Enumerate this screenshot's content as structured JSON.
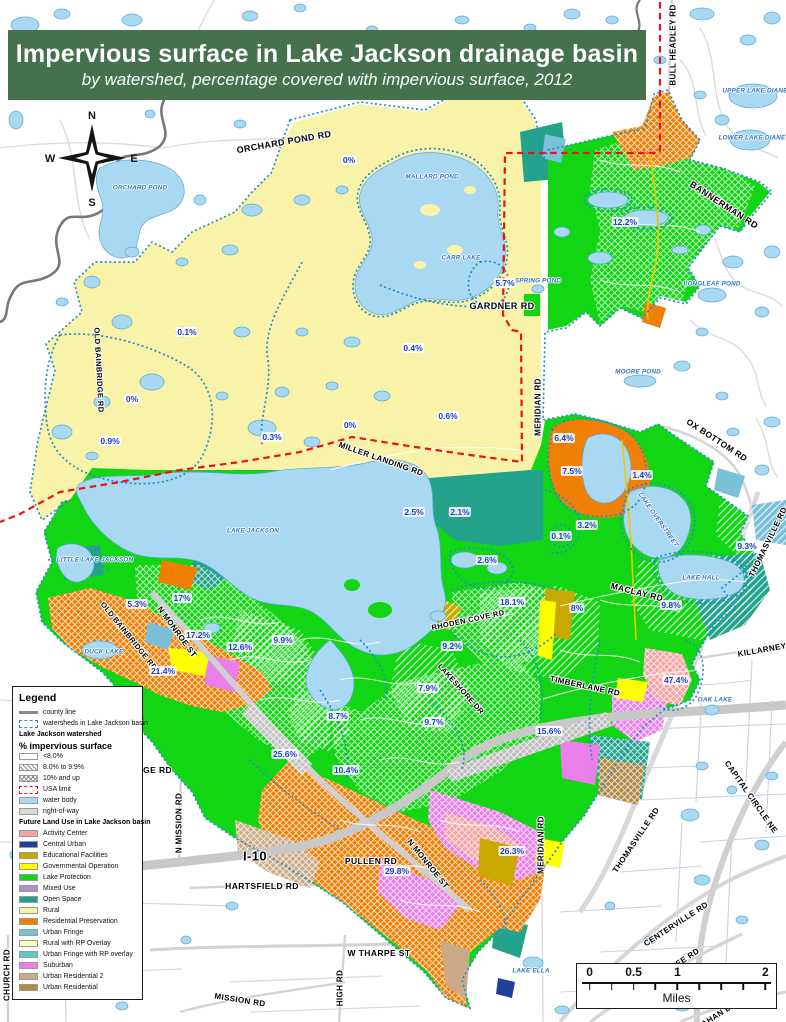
{
  "title": {
    "line1": "Impervious surface in Lake Jackson drainage basin",
    "line2": "by watershed, percentage covered with impervious surface, 2012"
  },
  "compass": {
    "n": "N",
    "e": "E",
    "s": "S",
    "w": "W"
  },
  "legend": {
    "title": "Legend",
    "items": [
      {
        "label": "county line",
        "type": "line",
        "color": "#8a8a8a"
      },
      {
        "label": "watersheds in Lake Jackson basin",
        "type": "dash",
        "color": "#1d8ec9"
      },
      {
        "label": "Lake Jackson watershed",
        "type": "header"
      },
      {
        "label": "% impervious surface",
        "type": "header-big"
      },
      {
        "label": "<8.0%",
        "type": "fill",
        "color": "#ffffff"
      },
      {
        "label": "8.0% to 9.9%",
        "type": "hatch-diag"
      },
      {
        "label": "10% and up",
        "type": "hatch-cross"
      },
      {
        "label": "USA limit",
        "type": "dash",
        "color": "#e81313"
      },
      {
        "label": "water body",
        "type": "fill",
        "color": "#a9d8f2"
      },
      {
        "label": "right-of-way",
        "type": "fill",
        "color": "#d9d9d9"
      },
      {
        "label": "Future Land Use in Lake Jackson basin",
        "type": "header"
      },
      {
        "label": "Activity Center",
        "type": "fill",
        "color": "#f5a3a3"
      },
      {
        "label": "Central Urban",
        "type": "fill",
        "color": "#20409a"
      },
      {
        "label": "Educational Facilities",
        "type": "fill",
        "color": "#c9a800"
      },
      {
        "label": "Governmental Operation",
        "type": "fill",
        "color": "#ffff00"
      },
      {
        "label": "Lake Protection",
        "type": "fill",
        "color": "#12d613"
      },
      {
        "label": "Mixed Use",
        "type": "fill",
        "color": "#b48fd0"
      },
      {
        "label": "Open Space",
        "type": "fill",
        "color": "#23a38c"
      },
      {
        "label": "Rural",
        "type": "fill",
        "color": "#f8f3a9"
      },
      {
        "label": "Residential Preservation",
        "type": "fill",
        "color": "#f08005"
      },
      {
        "label": "Urban Fringe",
        "type": "fill",
        "color": "#79c1d8"
      },
      {
        "label": "Rural with RP Overlay",
        "type": "fill",
        "color": "#fcf9c4"
      },
      {
        "label": "Urban Fringe with RP overlay",
        "type": "fill",
        "color": "#5cc8c4"
      },
      {
        "label": "Suburban",
        "type": "fill",
        "color": "#e97fe9"
      },
      {
        "label": "Urban Residential 2",
        "type": "fill",
        "color": "#cbab87"
      },
      {
        "label": "Urban Residential",
        "type": "fill",
        "color": "#b08948"
      }
    ]
  },
  "scalebar": {
    "unit": "Miles",
    "ticks": [
      {
        "label": "0",
        "pos": 4
      },
      {
        "label": "0.5",
        "pos": 27.3
      },
      {
        "label": "1",
        "pos": 50.5
      },
      {
        "label": "2",
        "pos": 97
      }
    ]
  },
  "map": {
    "roads": [
      {
        "t": "ORCHARD POND RD",
        "x": 284,
        "y": 142,
        "r": -10,
        "s": 9
      },
      {
        "t": "BULL HEADLEY RD",
        "x": 673,
        "y": 45,
        "r": -90,
        "s": 8
      },
      {
        "t": "BANNERMAN RD",
        "x": 724,
        "y": 205,
        "r": 33,
        "s": 9
      },
      {
        "t": "GARDNER RD",
        "x": 502,
        "y": 306,
        "r": 0,
        "s": 9
      },
      {
        "t": "MERIDIAN RD",
        "x": 538,
        "y": 407,
        "r": -90,
        "s": 8
      },
      {
        "t": "OLD BAINBRIDGE RD",
        "x": 99,
        "y": 370,
        "r": 87,
        "s": 7.5
      },
      {
        "t": "MILLER LANDING RD",
        "x": 381,
        "y": 459,
        "r": 19,
        "s": 8
      },
      {
        "t": "OX BOTTOM RD",
        "x": 717,
        "y": 440,
        "r": 33,
        "s": 8.5
      },
      {
        "t": "THOMASVILLE RD",
        "x": 768,
        "y": 542,
        "r": -64,
        "s": 8
      },
      {
        "t": "MACLAY RD",
        "x": 637,
        "y": 592,
        "r": 14,
        "s": 8.5
      },
      {
        "t": "KILLARNEY",
        "x": 762,
        "y": 650,
        "r": -10,
        "s": 8
      },
      {
        "t": "RHODEN COVE RD",
        "x": 468,
        "y": 620,
        "r": -12,
        "s": 7.5
      },
      {
        "t": "LAKESHORE DR",
        "x": 461,
        "y": 689,
        "r": 48,
        "s": 7.5
      },
      {
        "t": "TIMBERLANE RD",
        "x": 585,
        "y": 686,
        "r": 12,
        "s": 8
      },
      {
        "t": "OLD BAINBRIDGE RD",
        "x": 129,
        "y": 636,
        "r": 51,
        "s": 7.5
      },
      {
        "t": "N MONROE ST",
        "x": 177,
        "y": 632,
        "r": 54,
        "s": 8
      },
      {
        "t": "N MISSION RD",
        "x": 179,
        "y": 823,
        "r": -90,
        "s": 8
      },
      {
        "t": "I-10",
        "x": 255,
        "y": 856,
        "r": 0,
        "s": 13
      },
      {
        "t": "PULLEN RD",
        "x": 371,
        "y": 861,
        "r": 0,
        "s": 8.5
      },
      {
        "t": "HARTSFIELD RD",
        "x": 262,
        "y": 886,
        "r": 0,
        "s": 8.5
      },
      {
        "t": "N MONROE ST",
        "x": 428,
        "y": 864,
        "r": 51,
        "s": 8
      },
      {
        "t": "MERIDIAN RD",
        "x": 541,
        "y": 845,
        "r": -90,
        "s": 8
      },
      {
        "t": "THOMASVILLE RD",
        "x": 636,
        "y": 840,
        "r": -56,
        "s": 8
      },
      {
        "t": "CAPITAL CIRCLE NE",
        "x": 751,
        "y": 797,
        "r": 55,
        "s": 8
      },
      {
        "t": "W THARPE ST",
        "x": 379,
        "y": 953,
        "r": 0,
        "s": 8.5
      },
      {
        "t": "HIGH RD",
        "x": 340,
        "y": 988,
        "r": -90,
        "s": 8
      },
      {
        "t": "MISSION RD",
        "x": 240,
        "y": 1000,
        "r": 9,
        "s": 8
      },
      {
        "t": "CENTERVILLE RD",
        "x": 676,
        "y": 924,
        "r": -33,
        "s": 8
      },
      {
        "t": "CHURCH RD",
        "x": 7,
        "y": 975,
        "r": -90,
        "s": 8
      },
      {
        "t": "FORGE RD",
        "x": 148,
        "y": 770,
        "r": 0,
        "s": 8.5
      },
      {
        "t": "MICCOSUKEE RD",
        "x": 668,
        "y": 970,
        "r": -33,
        "s": 8
      },
      {
        "t": "MAHAN DR",
        "x": 716,
        "y": 1016,
        "r": -33,
        "s": 8
      }
    ],
    "lakes": [
      {
        "t": "ORCHARD POND",
        "x": 140,
        "y": 188,
        "r": 0
      },
      {
        "t": "MALLARD POND",
        "x": 432,
        "y": 177,
        "r": 0
      },
      {
        "t": "CARR LAKE",
        "x": 461,
        "y": 258,
        "r": 0
      },
      {
        "t": "LAKE JACKSON",
        "x": 253,
        "y": 531,
        "r": 0
      },
      {
        "t": "LITTLE LAKE JACKSON",
        "x": 95,
        "y": 560,
        "r": 0
      },
      {
        "t": "DUCK LAKE",
        "x": 104,
        "y": 652,
        "r": 0
      },
      {
        "t": "LAKE OVERSTREET",
        "x": 658,
        "y": 520,
        "r": 55
      },
      {
        "t": "LAKE HALL",
        "x": 701,
        "y": 578,
        "r": 0
      },
      {
        "t": "LONGLEAF POND",
        "x": 712,
        "y": 284,
        "r": 0
      },
      {
        "t": "MOORE POND",
        "x": 638,
        "y": 372,
        "r": 0
      },
      {
        "t": "SPRING POND",
        "x": 538,
        "y": 281,
        "r": 0
      },
      {
        "t": "OAK LAKE",
        "x": 715,
        "y": 700,
        "r": 0
      },
      {
        "t": "LAKE ELLA",
        "x": 531,
        "y": 971,
        "r": 0
      },
      {
        "t": "UPPER LAKE DIANE",
        "x": 755,
        "y": 91,
        "r": 0
      },
      {
        "t": "LOWER LAKE DIANE",
        "x": 752,
        "y": 138,
        "r": 0
      }
    ],
    "percents": [
      {
        "t": "0%",
        "x": 349,
        "y": 160
      },
      {
        "t": "12.2%",
        "x": 625,
        "y": 222
      },
      {
        "t": "5.7%",
        "x": 505,
        "y": 283
      },
      {
        "t": "0.1%",
        "x": 187,
        "y": 332
      },
      {
        "t": "0.4%",
        "x": 413,
        "y": 348
      },
      {
        "t": "0%",
        "x": 132,
        "y": 399
      },
      {
        "t": "0.6%",
        "x": 448,
        "y": 416
      },
      {
        "t": "0%",
        "x": 350,
        "y": 425
      },
      {
        "t": "0.3%",
        "x": 272,
        "y": 437
      },
      {
        "t": "0.9%",
        "x": 110,
        "y": 441
      },
      {
        "t": "6.4%",
        "x": 564,
        "y": 438
      },
      {
        "t": "7.5%",
        "x": 572,
        "y": 471
      },
      {
        "t": "1.4%",
        "x": 642,
        "y": 475
      },
      {
        "t": "2.5%",
        "x": 414,
        "y": 512
      },
      {
        "t": "2.1%",
        "x": 460,
        "y": 512
      },
      {
        "t": "3.2%",
        "x": 587,
        "y": 525
      },
      {
        "t": "0.1%",
        "x": 561,
        "y": 536
      },
      {
        "t": "9.3%",
        "x": 747,
        "y": 546
      },
      {
        "t": "2.6%",
        "x": 487,
        "y": 560
      },
      {
        "t": "17%",
        "x": 182,
        "y": 598
      },
      {
        "t": "18.1%",
        "x": 512,
        "y": 602
      },
      {
        "t": "5.3%",
        "x": 137,
        "y": 604
      },
      {
        "t": "8%",
        "x": 577,
        "y": 608
      },
      {
        "t": "9.8%",
        "x": 671,
        "y": 605
      },
      {
        "t": "17.2%",
        "x": 198,
        "y": 635
      },
      {
        "t": "9.9%",
        "x": 283,
        "y": 640
      },
      {
        "t": "9.2%",
        "x": 452,
        "y": 646
      },
      {
        "t": "12.6%",
        "x": 240,
        "y": 647
      },
      {
        "t": "21.4%",
        "x": 163,
        "y": 671
      },
      {
        "t": "47.4%",
        "x": 676,
        "y": 680
      },
      {
        "t": "7.9%",
        "x": 428,
        "y": 688
      },
      {
        "t": "8.7%",
        "x": 338,
        "y": 716
      },
      {
        "t": "9.7%",
        "x": 434,
        "y": 722
      },
      {
        "t": "15.6%",
        "x": 549,
        "y": 731
      },
      {
        "t": "25.6%",
        "x": 285,
        "y": 754
      },
      {
        "t": "10.4%",
        "x": 346,
        "y": 770
      },
      {
        "t": "29.8%",
        "x": 397,
        "y": 871
      },
      {
        "t": "26.3%",
        "x": 512,
        "y": 851
      }
    ]
  },
  "colors": {
    "banner": "#45714d",
    "water": "#a9d8f2",
    "rural": "#f8f3a9",
    "lake_protection": "#12d613",
    "open_space": "#23a38c",
    "residential_preservation": "#f08005",
    "suburban": "#e97fe9",
    "activity_center": "#f5a3a3",
    "mixed_use": "#b48fd0",
    "educational_facilities": "#c9a800",
    "governmental_operation": "#ffff00",
    "urban_fringe": "#79c1d8",
    "urban_fringe_rp": "#5cc8c4",
    "rural_rp": "#fcf9c4",
    "urban_residential": "#b08948",
    "urban_residential_2": "#cbab87",
    "central_urban": "#20409a",
    "usa_limit": "#e81313",
    "watershed_boundary": "#1d8ec9",
    "county_line": "#787878",
    "right_of_way": "#d9d9d9"
  }
}
